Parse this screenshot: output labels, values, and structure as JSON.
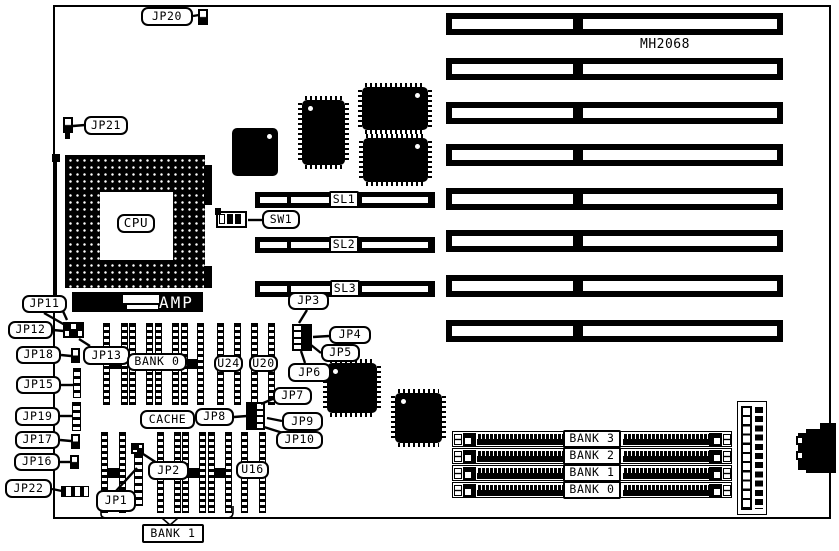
{
  "colors": {
    "ink": "#000000",
    "paper": "#ffffff"
  },
  "board": {
    "id_label": "MH2068"
  },
  "callouts": {
    "jp1": "JP1",
    "jp2": "JP2",
    "jp3": "JP3",
    "jp4": "JP4",
    "jp5": "JP5",
    "jp6": "JP6",
    "jp7": "JP7",
    "jp8": "JP8",
    "jp9": "JP9",
    "jp10": "JP10",
    "jp11": "JP11",
    "jp12": "JP12",
    "jp13": "JP13",
    "jp15": "JP15",
    "jp16": "JP16",
    "jp17": "JP17",
    "jp18": "JP18",
    "jp19": "JP19",
    "jp20": "JP20",
    "jp21": "JP21",
    "jp22": "JP22",
    "sw1": "SW1"
  },
  "slots": {
    "sl1": "SL1",
    "sl2": "SL2",
    "sl3": "SL3"
  },
  "cpu": {
    "label": "CPU"
  },
  "connectors": {
    "amp": "AMP"
  },
  "chips": {
    "u24": "U24",
    "u20": "U20",
    "u16": "U16"
  },
  "memory": {
    "bank0": "BANK 0",
    "bank1": "BANK 1",
    "cache": "CACHE",
    "simm_banks": [
      "BANK 3",
      "BANK 2",
      "BANK 1",
      "BANK 0"
    ]
  }
}
